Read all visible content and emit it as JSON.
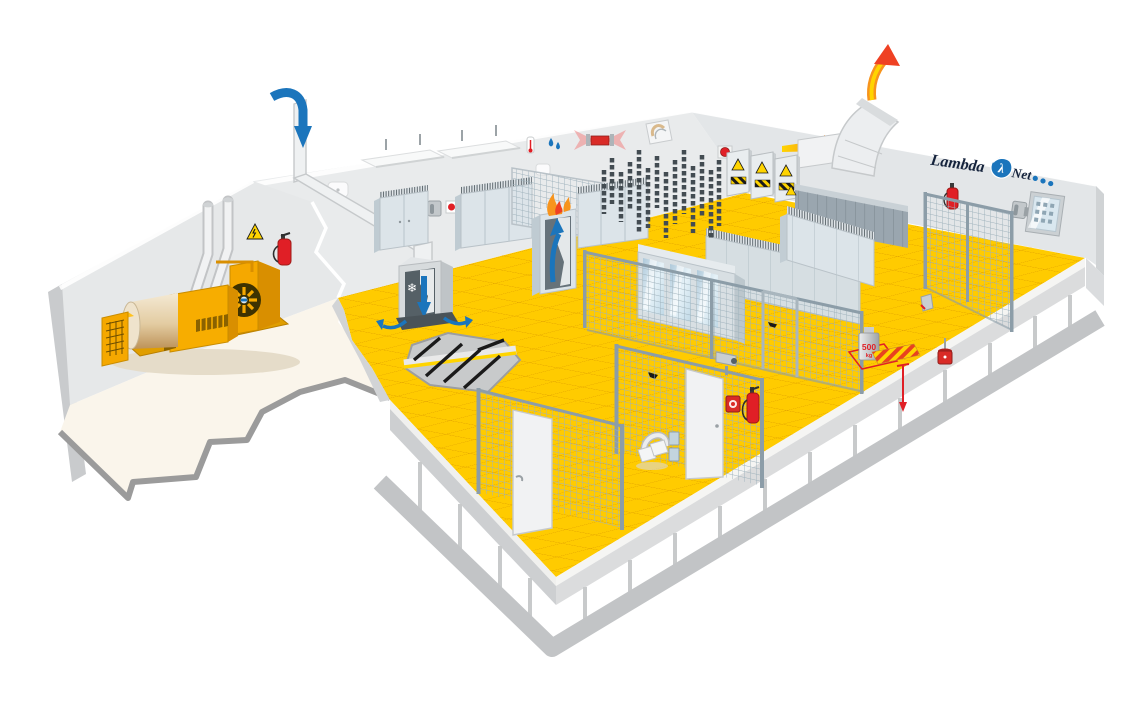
{
  "brand": {
    "word_left": "Lambda",
    "symbol": "λ",
    "word_right": "Net",
    "dot_count": 3
  },
  "floor_load_marker": {
    "value": "500",
    "unit": "kg"
  },
  "icons": {
    "snowflake_glyph": "❄"
  },
  "equipment": [
    "diesel-generator",
    "generator-exhaust-pipes",
    "air-intake-duct",
    "crac-cooling-unit",
    "underfloor-airflow",
    "hot-air-exhaust-duct",
    "server-racks",
    "glass-door-racks",
    "electrical-panels",
    "cable-chains",
    "underfloor-cable-trays",
    "raised-floor-pedestals",
    "security-fence",
    "security-doors",
    "security-camera",
    "card-reader",
    "fire-extinguishers",
    "smoke-detectors",
    "beam-smoke-detector",
    "thermometer",
    "humidity-sensor",
    "wall-vent",
    "emergency-stop-button",
    "floor-load-weight",
    "floor-height-marker",
    "floor-tile-lifter",
    "wall-phones",
    "breaker-panel",
    "ceiling-lights",
    "warning-signs"
  ],
  "colors": {
    "floorY": "#FFCB00",
    "floorGrid": "#DF9E00",
    "wall": "#E9EBEC",
    "wallR": "#E3E6E8",
    "wallD": "#C9CBCD",
    "cream": "#FAF5EB",
    "outline": "#9B9B9B",
    "slab": "#DBDCDD",
    "slabL": "#CDCFD1",
    "found": "#C2C4C6",
    "machY": "#F5A800",
    "machD": "#D98F00",
    "machT": "#FFC21E",
    "tanHi": "#F4E9D4",
    "tanLo": "#BD9258",
    "duct": "#EFF1F2",
    "ductE": "#C6C9CB",
    "blue": "#1B75BC",
    "hotO": "#F7941D",
    "hotR": "#EF4123",
    "hotY": "#FFD400",
    "red": "#E01F26",
    "redD": "#9E1B18",
    "rackF": "#DCE4E9",
    "rackS": "#BFCBD2",
    "rackT": "#EAEFF2",
    "rackDk": "#9AA6AF",
    "mesh": "#9FB2BC",
    "frame": "#8C9DA8",
    "glassA": "#AFC9DA",
    "glassB": "#E6F2F8",
    "ink": "#1A1A1A",
    "navy": "#15233C",
    "doorW": "#F1F2F3"
  }
}
